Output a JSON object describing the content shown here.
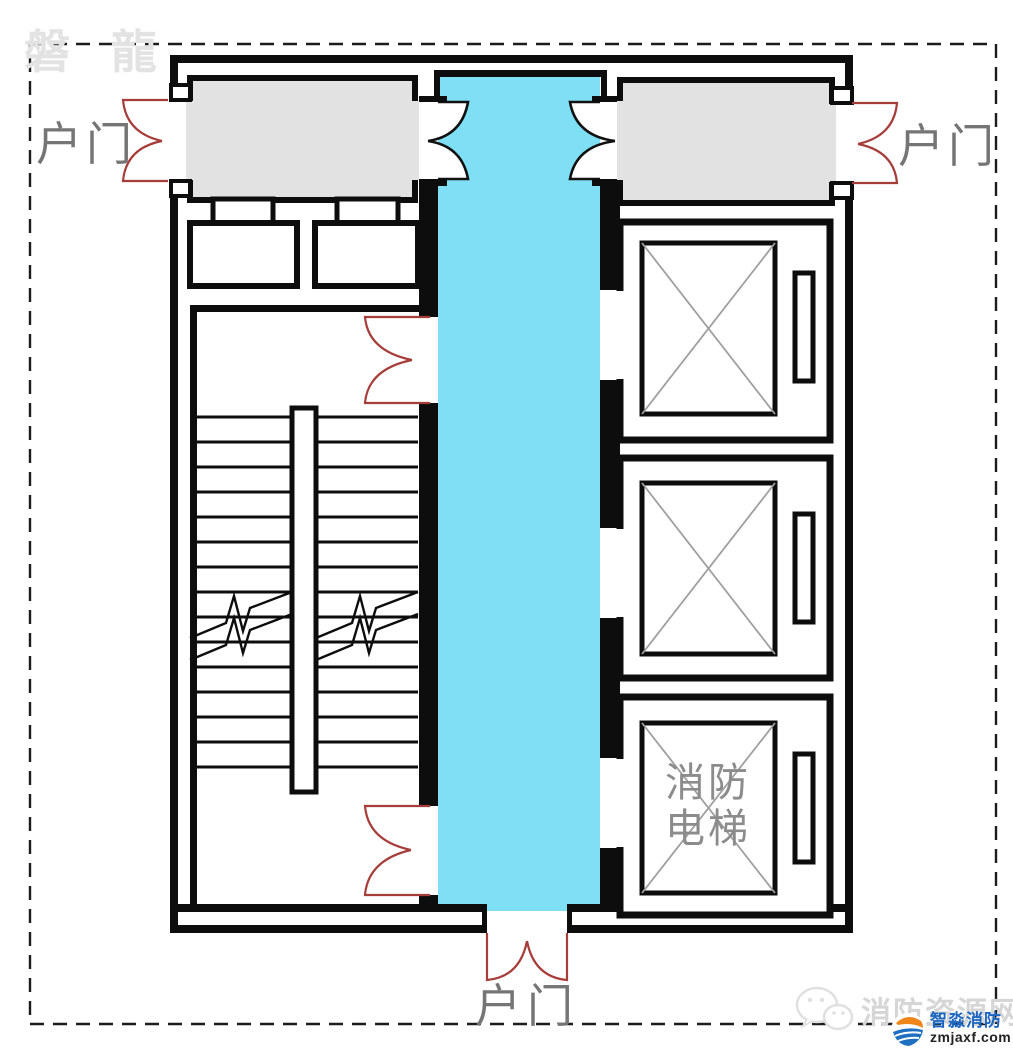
{
  "watermark": {
    "brand_text": "磐 龍"
  },
  "plan": {
    "labels": {
      "door_left": "户门",
      "door_right": "户门",
      "door_bottom": "户门",
      "fire_elevator": [
        "消防",
        "电梯"
      ]
    },
    "colors": {
      "corridor": "#7fdff4",
      "door_red": "#a63d3a",
      "room_gray": "#e2e2e2",
      "wall_black": "#0d0d0d",
      "car_x_gray": "#9f9f9f"
    }
  },
  "footer": {
    "watermark_site": "消防资源网",
    "logo_name": "智淼消防",
    "logo_domain": "zmjaxf.com",
    "logo_blue": "#1a66c2",
    "logo_orange": "#f08519"
  }
}
